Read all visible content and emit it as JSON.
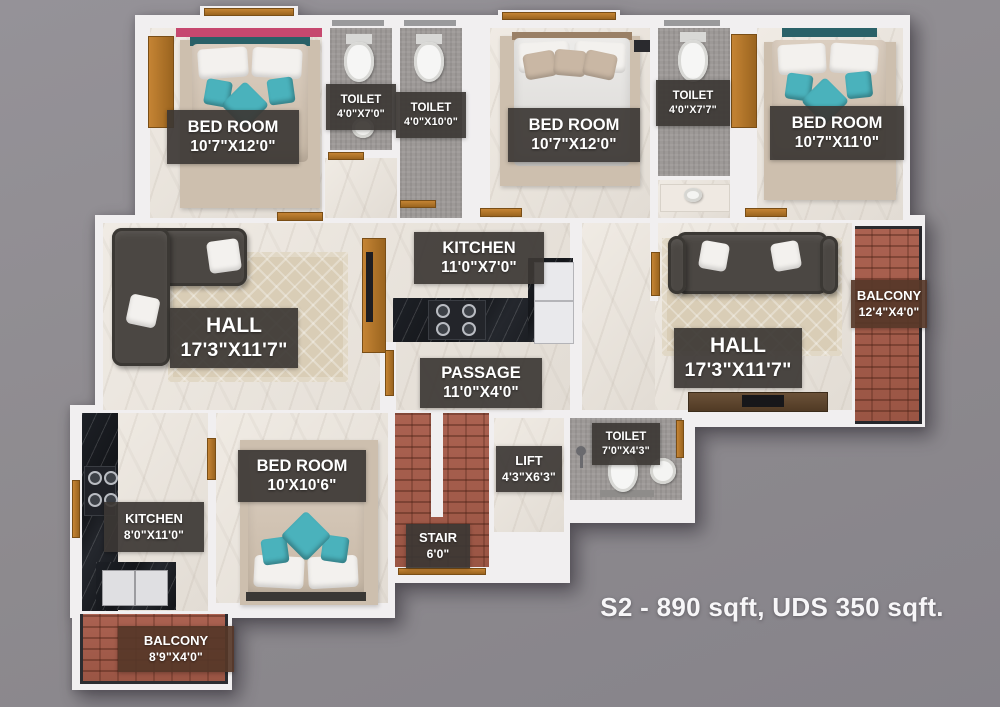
{
  "scene": {
    "type": "apartment-floor-plan-3d-top-view",
    "caption": "S2 - 890 sqft, UDS 350 sqft."
  },
  "rooms": [
    {
      "id": "bedroom-top-left",
      "name": "BED ROOM",
      "dims": "10'7\"X12'0\""
    },
    {
      "id": "toilet-top-left",
      "name": "TOILET",
      "dims": "4'0\"X7'0\""
    },
    {
      "id": "toilet-top-mid",
      "name": "TOILET",
      "dims": "4'0\"X10'0\""
    },
    {
      "id": "bedroom-top-center",
      "name": "BED ROOM",
      "dims": "10'7\"X12'0\""
    },
    {
      "id": "toilet-top-right",
      "name": "TOILET",
      "dims": "4'0\"X7'7\""
    },
    {
      "id": "bedroom-top-right",
      "name": "BED ROOM",
      "dims": "10'7\"X11'0\""
    },
    {
      "id": "kitchen-center",
      "name": "KITCHEN",
      "dims": "11'0\"X7'0\""
    },
    {
      "id": "hall-left",
      "name": "HALL",
      "dims": "17'3\"X11'7\""
    },
    {
      "id": "hall-right",
      "name": "HALL",
      "dims": "17'3\"X11'7\""
    },
    {
      "id": "balcony-right",
      "name": "BALCONY",
      "dims": "12'4\"X4'0\""
    },
    {
      "id": "passage",
      "name": "PASSAGE",
      "dims": "11'0\"X4'0\""
    },
    {
      "id": "bedroom-bottom",
      "name": "BED ROOM",
      "dims": "10'X10'6\""
    },
    {
      "id": "kitchen-left",
      "name": "KITCHEN",
      "dims": "8'0\"X11'0\""
    },
    {
      "id": "stair",
      "name": "STAIR",
      "dims": "6'0\""
    },
    {
      "id": "lift",
      "name": "LIFT",
      "dims": "4'3\"X6'3\""
    },
    {
      "id": "toilet-bottom",
      "name": "TOILET",
      "dims": "7'0\"X4'3\""
    },
    {
      "id": "balcony-bottom",
      "name": "BALCONY",
      "dims": "8'9\"X4'0\""
    }
  ],
  "colors": {
    "background": "#8d8a8e",
    "wall": "#f1eff0",
    "marble_floor": "#e9e4dd",
    "tile_floor": "#9d9997",
    "brick": "#a65e4b",
    "wood": "#b5762f",
    "teal_accent": "#4ab2bc",
    "pink_accent": "#c6486f",
    "label_bg": "#3c3734",
    "balcony_label_bg": "#563728",
    "caption_text": "#f7f6f8"
  }
}
